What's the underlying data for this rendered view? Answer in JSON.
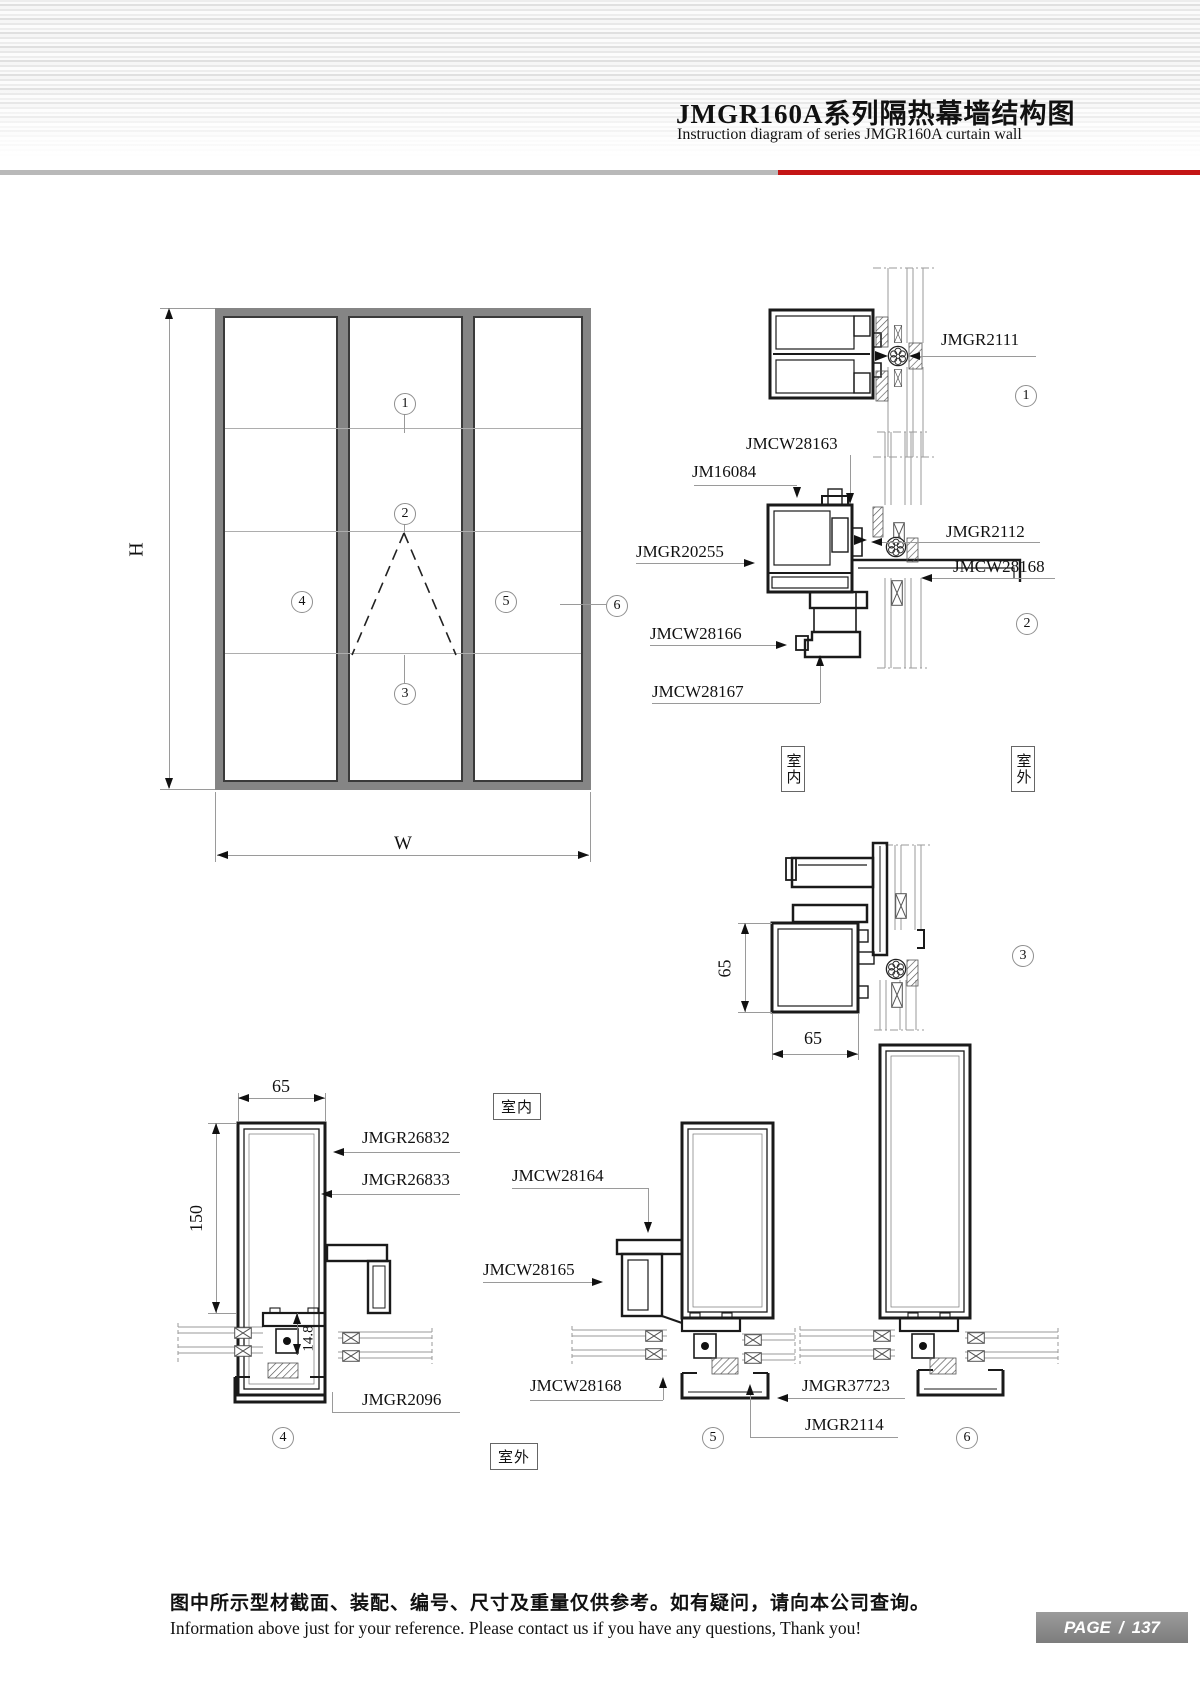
{
  "header": {
    "title_cn": "JMGR160A系列隔热幕墙结构图",
    "title_en": "Instruction diagram of series JMGR160A curtain wall"
  },
  "elevation": {
    "dim_h": "H",
    "dim_w": "W",
    "markers": [
      "1",
      "2",
      "3",
      "4",
      "5",
      "6"
    ]
  },
  "room": {
    "indoor": "室内",
    "outdoor": "室外"
  },
  "details": {
    "d1": {
      "number": "1",
      "part": "JMGR2111"
    },
    "d2": {
      "number": "2",
      "parts": {
        "a": "JMCW28163",
        "b": "JM16084",
        "c": "JMGR20255",
        "d": "JMCW28166",
        "e": "JMCW28167",
        "f": "JMGR2112",
        "g": "JMCW28168"
      }
    },
    "d3": {
      "number": "3",
      "dim_v": "65",
      "dim_h": "65"
    },
    "d4": {
      "number": "4",
      "dim_top": "65",
      "dim_side": "150",
      "dim_small": "14.8",
      "parts": {
        "a": "JMGR26832",
        "b": "JMGR26833",
        "c": "JMGR2096"
      }
    },
    "d5": {
      "number": "5",
      "parts": {
        "a": "JMCW28164",
        "b": "JMCW28165",
        "c": "JMCW28168",
        "d": "JMGR37723",
        "e": "JMGR2114"
      }
    },
    "d6": {
      "number": "6"
    }
  },
  "footer": {
    "note_cn": "图中所示型材截面、装配、编号、尺寸及重量仅供参考。如有疑问，请向本公司查询。",
    "note_en": "Information above just for your reference. Please contact us if you have any questions, Thank you!",
    "page_label": "PAGE",
    "page_sep": "/",
    "page_number": "137"
  }
}
